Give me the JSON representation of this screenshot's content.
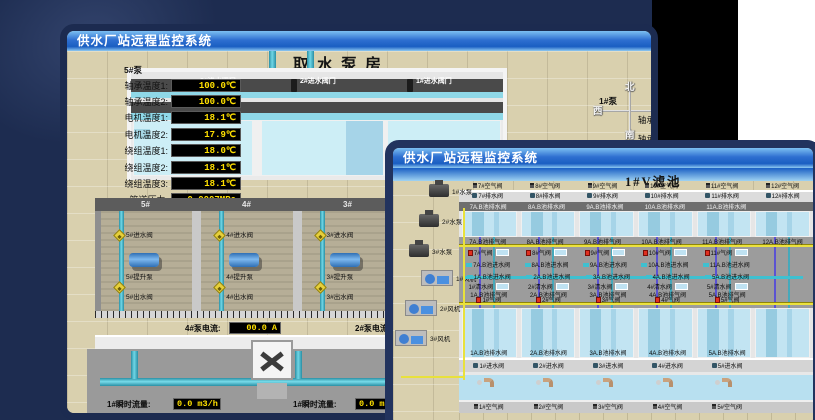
{
  "colors": {
    "backdrop": "#1d2c50",
    "titlebar_blue": "#2e6fd0",
    "value_yellow": "#ffe000",
    "pipe_teal": "#3fc0d0",
    "valve_red": "#e03020",
    "water_blue": "#bfe2f2",
    "ground_tan": "#d9d0ae"
  },
  "bg_window": {
    "title": "供水厂站远程监控系统",
    "scene_title": "取水泵房",
    "pump_header": "5#泵",
    "readouts": [
      {
        "label": "轴承温度1:",
        "value": "100.0℃"
      },
      {
        "label": "轴承温度2:",
        "value": "100.0℃"
      },
      {
        "label": "电机温度1:",
        "value": "18.1℃"
      },
      {
        "label": "电机温度2:",
        "value": "17.9℃"
      },
      {
        "label": "绕组温度1:",
        "value": "18.0℃"
      },
      {
        "label": "绕组温度2:",
        "value": "18.1℃"
      },
      {
        "label": "绕组温度3:",
        "value": "18.1℃"
      },
      {
        "label": "管道压力:",
        "value": "0.0007MPa"
      },
      {
        "label": "多功能阀:",
        "value": "0%"
      }
    ],
    "intake_valves": [
      "3#进水阀门",
      "2#进水阀门",
      "1#进水阀门"
    ],
    "compass": {
      "north": "北",
      "south": "南",
      "west": "西",
      "east": "东"
    },
    "right_panel": {
      "header": "1#泵",
      "rows": [
        "轴承温度1:",
        "轴承温度2:"
      ]
    },
    "pump_bays": [
      {
        "id": "5#",
        "inlet": "5#进水阀",
        "lift": "5#提升泵",
        "outlet": "5#出水阀"
      },
      {
        "id": "4#",
        "inlet": "4#进水阀",
        "lift": "4#提升泵",
        "outlet": "4#出水阀"
      },
      {
        "id": "3#",
        "inlet": "3#进水阀",
        "lift": "3#提升泵",
        "outlet": "3#出水阀"
      },
      {
        "id": "2#",
        "inlet": "2#进水阀",
        "lift": "2#提升泵",
        "outlet": "2#出水阀"
      }
    ],
    "current": [
      {
        "label": "4#泵电流:",
        "value": "00.0 A"
      },
      {
        "label": "2#泵电流:",
        "value": ""
      }
    ],
    "flow": [
      {
        "label": "1#瞬时流量:",
        "value": "0.0 m3/h"
      },
      {
        "label": "1#瞬时流量:",
        "value": "0.0 m3/h"
      }
    ]
  },
  "fg_window": {
    "title": "供水厂站远程监控系统",
    "scene_title": "1#V滤池",
    "equipment": [
      "1#水泵",
      "2#水泵",
      "3#水泵",
      "1#风机",
      "2#风机",
      "3#风机"
    ],
    "pool_columns_upper": [
      "7",
      "8",
      "9",
      "10",
      "11",
      "12"
    ],
    "pool_columns_lower": [
      "1",
      "2",
      "3",
      "4",
      "5",
      "6"
    ],
    "top_air": [
      "7#空气阀",
      "8#空气阀",
      "9#空气阀",
      "10#空气阀",
      "11#空气阀",
      "12#空气阀"
    ],
    "top_drain": [
      "7#排水阀",
      "8#排水阀",
      "9#排水阀",
      "10#排水阀",
      "11#排水阀",
      "12#排水阀"
    ],
    "upper_pool_drain": [
      "7A.B池排水阀",
      "8A.B池排水阀",
      "9A.B池排水阀",
      "10A.B池排水阀",
      "11A.B池排水阀"
    ],
    "upper_exhaust": [
      "7A.B池排气阀",
      "8A.B池排气阀",
      "9A.B池排气阀",
      "10A.B池排气阀",
      "11A.B池排气阀",
      "12A.B池排气阀"
    ],
    "upper_gas": [
      "7#气阀",
      "8#气阀",
      "9#气阀",
      "10#气阀",
      "11#气阀"
    ],
    "upper_inlet": [
      "7A.B池进水阀",
      "8A.B池进水阀",
      "9A.B池进水阀",
      "10A.B池进水阀",
      "11A.B池进水阀"
    ],
    "lower_inlet": [
      "1A.B池进水阀",
      "2A.B池进水阀",
      "3A.B池进水阀",
      "4A.B池进水阀",
      "5A.B池进水阀"
    ],
    "lower_clear": [
      "1#清水阀",
      "2#清水阀",
      "3#清水阀",
      "4#清水阀",
      "5#清水阀"
    ],
    "lower_exhaust": [
      "1A.B池排气阀",
      "2A.B池排气阀",
      "3A.B池排气阀",
      "4A.B池排气阀",
      "5A.B池排气阀"
    ],
    "lower_gas": [
      "1#气阀",
      "2#气阀",
      "3#气阀",
      "4#气阀",
      "5#气阀"
    ],
    "lower_pool_drain": [
      "1A.B池排水阀",
      "2A.B池排水阀",
      "3A.B池排水阀",
      "4A.B池排水阀",
      "5A.B池排水阀"
    ],
    "bottom_inlet": [
      "1#进水阀",
      "2#进水阀",
      "3#进水阀",
      "4#进水阀",
      "5#进水阀"
    ],
    "bottom_air": [
      "1#空气阀",
      "2#空气阀",
      "3#空气阀",
      "4#空气阀",
      "5#空气阀"
    ]
  }
}
